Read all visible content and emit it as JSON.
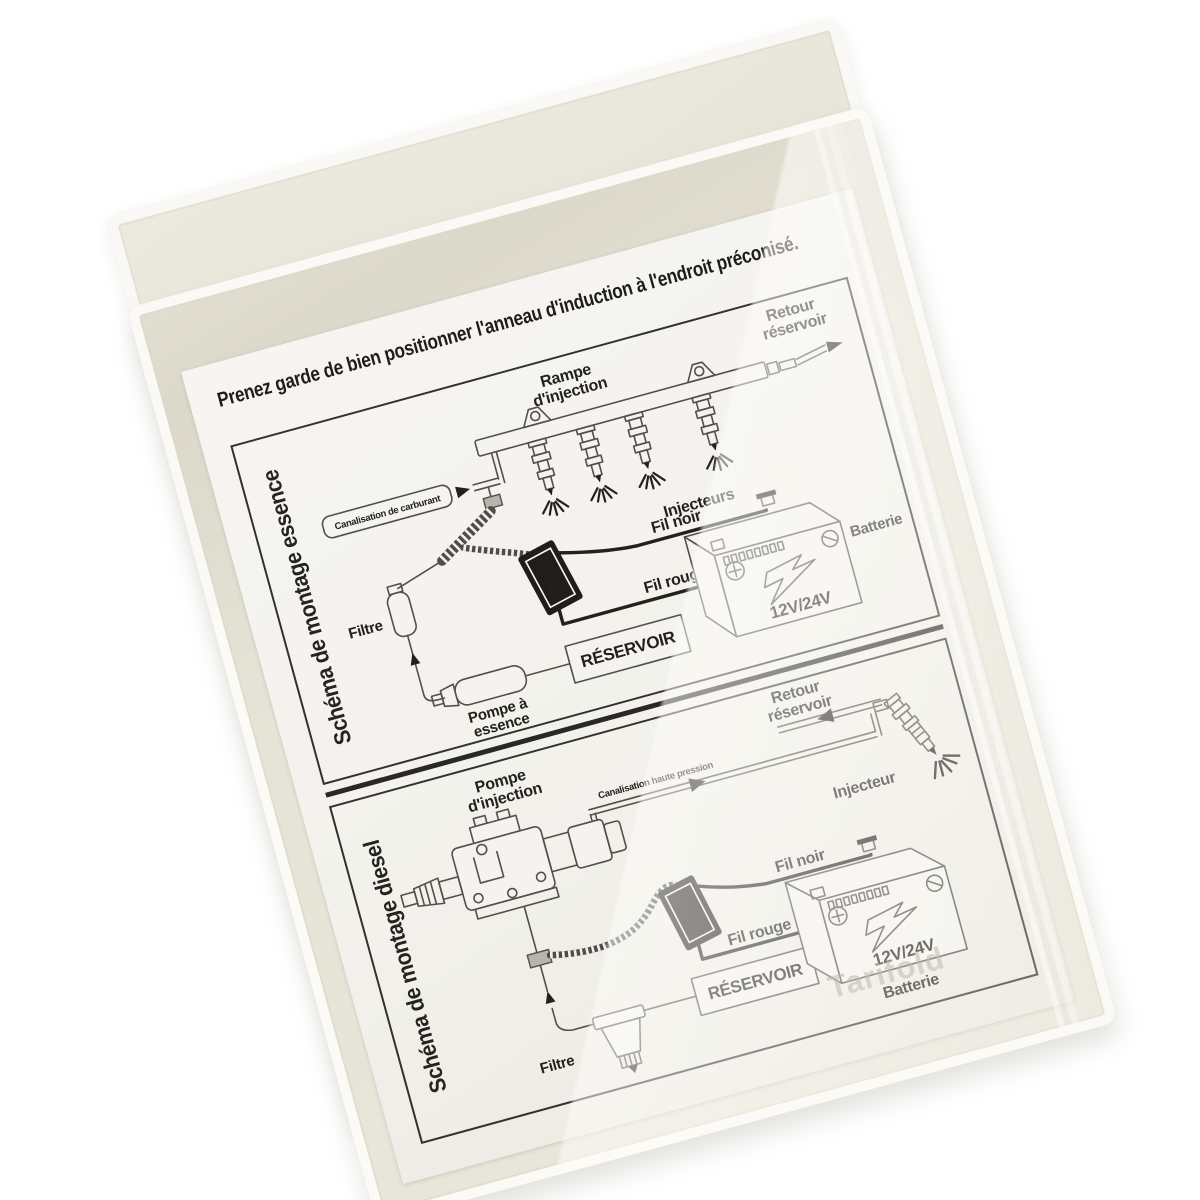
{
  "photo": {
    "watermark": "Tarifold",
    "colors": {
      "background": "#ffffff",
      "sleeve": "#e7e4d8",
      "sleeve_edge": "#fbfaf6",
      "paper": "#f2f1ec",
      "ink": "#23211c",
      "device_box": "#201e1a"
    }
  },
  "sheet": {
    "title": "Prenez garde de bien positionner l'anneau d'induction à l'endroit préconisé.",
    "essence": {
      "side_label": "Schéma de montage essence",
      "canalisation": "Canalisation de carburant",
      "rampe_l1": "Rampe",
      "rampe_l2": "d'injection",
      "retour_l1": "Retour",
      "retour_l2": "réservoir",
      "injecteurs": "Injecteurs",
      "filtre": "Filtre",
      "device": "OES",
      "fil_noir": "Fil noir",
      "fil_rouge": "Fil rouge",
      "pompe_l1": "Pompe à",
      "pompe_l2": "essence",
      "reservoir": "RÉSERVOIR",
      "batterie": "Batterie",
      "voltage": "12V/24V"
    },
    "diesel": {
      "side_label": "Schéma de montage diesel",
      "pompe_l1": "Pompe",
      "pompe_l2": "d'injection",
      "canalisation": "Canalisation haute pression",
      "retour_l1": "Retour",
      "retour_l2": "réservoir",
      "injecteur": "Injecteur",
      "device": "OES",
      "fil_noir": "Fil noir",
      "fil_rouge": "Fil rouge",
      "voltage": "12V/24V",
      "batterie": "Batterie",
      "reservoir": "RÉSERVOIR",
      "filtre": "Filtre"
    }
  }
}
